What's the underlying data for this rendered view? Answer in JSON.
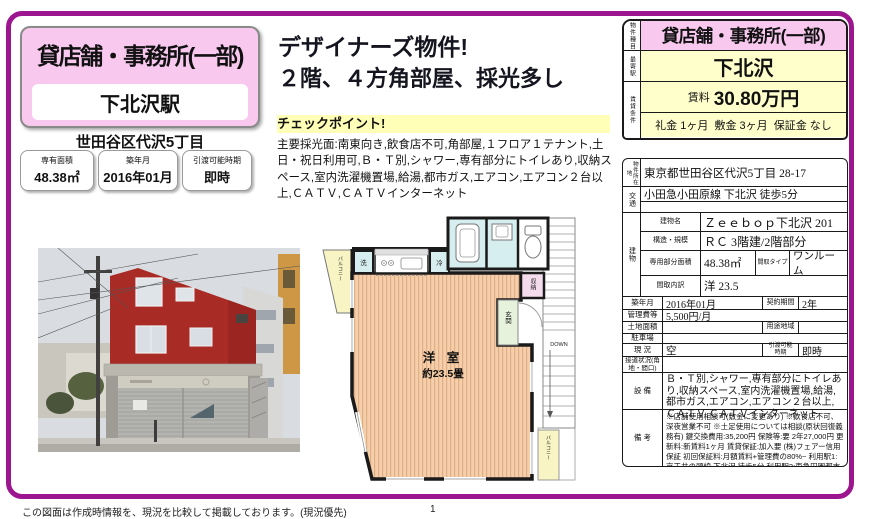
{
  "colors": {
    "frame": "#9C1690",
    "pink": "#F8C8EF",
    "yellow": "#FFFFCC",
    "highlight": "#FFFFB8"
  },
  "header": {
    "property_type": "貸店舗・事務所(一部)",
    "station": "下北沢駅",
    "address_short": "世田谷区代沢5丁目",
    "info_boxes": [
      {
        "label": "専有面積",
        "value": "48.38㎡"
      },
      {
        "label": "築年月",
        "value": "2016年01月"
      },
      {
        "label": "引渡可能時期",
        "value": "即時"
      }
    ]
  },
  "catch": {
    "line1": "デザイナーズ物件!",
    "line2": "２階、４方角部屋、採光多し",
    "checkpoint_label": "チェックポイント!",
    "checkpoint_text": "主要採光面:南東向き,飲食店不可,角部屋,１フロア１テナント,土日・祝日利用可,Ｂ・Ｔ別,シャワー,専有部分にトイレあり,収納スペース,室内洗濯機置場,給湯,都市ガス,エアコン,エアコン２台以上,ＣＡＴＶ,ＣＡＴＶインターネット"
  },
  "summary_table": {
    "type_label": "物件種目",
    "type_value": "貸店舗・事務所(一部)",
    "station_label": "最寄駅",
    "station_value": "下北沢",
    "terms_label": "賃貸条件",
    "rent_label": "賃料",
    "rent_value": "30.80万円",
    "terms_value": "礼金 1ヶ月  敷金 3ヶ月  保証金 なし"
  },
  "detail_table": {
    "location_label": "物件所在地",
    "location": "東京都世田谷区代沢5丁目 28-17",
    "access_label": "交通",
    "access": "小田急小田原線 下北沢 徒歩5分",
    "building_label": "建物",
    "building_name_label": "建物名",
    "building_name": "Ｚｅｅｂｏｐ下北沢 201",
    "structure_label": "構造・規模",
    "structure": "ＲＣ 3階建/2階部分",
    "area_label": "専用部分面積",
    "area": "48.38㎡",
    "layout_type_label": "間取タイプ",
    "layout_type": "ワンルーム",
    "layout_detail_label": "間取内訳",
    "layout_detail": "洋 23.5",
    "built_label": "築年月",
    "built": "2016年01月",
    "contract_label": "契約期間",
    "contract": "2年",
    "mgmt_label": "管理費等",
    "mgmt": "5,500円/月",
    "land_label": "土地面積",
    "land": "",
    "zoning_label": "用途地域",
    "zoning": "",
    "parking_label": "駐車場",
    "parking": "",
    "status_label": "現 況",
    "status": "空",
    "handover_label": "引渡可能時期",
    "handover": "即時",
    "road_label": "接道状況(角地・間口)",
    "road": "",
    "equipment_label": "設 備",
    "equipment": "Ｂ・Ｔ別,シャワー,専有部分にトイレあり,収納スペース,室内洗濯機置場,給湯,都市ガス,エアコン,エアコン２台以上,ＣＡＴＶ,ＣＡＴＶインターネット",
    "remarks_label": "備 考",
    "remarks": "※店舗使用相談可(敷金に変更あり) ※飲食店不可、深夜営業不可 ※土足使用については相談(原状回復義務有) 鍵交換費用:35,200円 保険等:要 2年27,000円 更新料:新賃料1ヶ月 賃貸保証:加入要 (株)フェアー信用保証 初回保証料:月額賃料+管理費の80%~ 利用駅1:京王井の頭線 下北沢 徒歩5分 利用駅2:東急田園都市線 三軒茶屋 徒歩23分"
  },
  "floorplan": {
    "room": "洋 室",
    "size": "約23.5畳",
    "balcony_top": "バルコニー",
    "balcony_bottom": "バルコニー",
    "washer": "洗",
    "fridge": "冷",
    "storage": "収納",
    "entrance": "玄関",
    "down": "DOWN"
  },
  "footer": {
    "disclaimer": "この図面は作成時情報を、現況を比較して掲載しております。(現況優先)",
    "page_number": "1"
  }
}
